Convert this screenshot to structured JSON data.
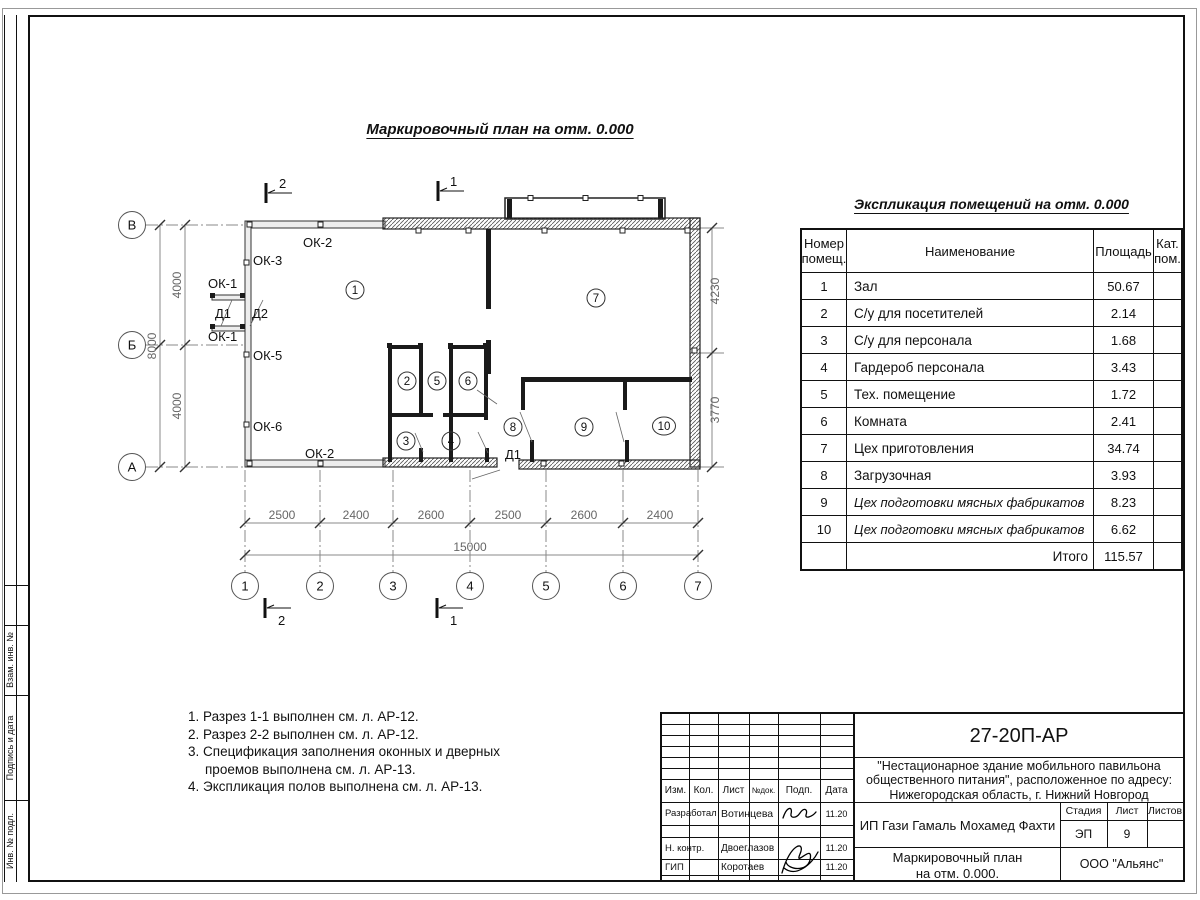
{
  "title": "Маркировочный план на отм. 0.000",
  "plan": {
    "marks": {
      "t2": "2",
      "t1": "1",
      "b2": "2",
      "b1": "1"
    },
    "rooms": [
      "1",
      "2",
      "3",
      "4",
      "5",
      "6",
      "7",
      "8",
      "9",
      "10"
    ],
    "row_axes": [
      "В",
      "Б",
      "А"
    ],
    "col_axes": [
      "1",
      "2",
      "3",
      "4",
      "5",
      "6",
      "7"
    ],
    "labels": {
      "ok2a": "ОК-2",
      "ok3": "ОК-3",
      "ok1a": "ОК-1",
      "d1": "Д1",
      "d2": "Д2",
      "ok1b": "ОК-1",
      "ok5": "ОК-5",
      "ok6": "ОК-6",
      "ok2b": "ОК-2",
      "d1b": "Д1"
    },
    "dims": {
      "v4000a": "4000",
      "v8000": "8000",
      "v4000b": "4000",
      "r4230": "4230",
      "r3770": "3770",
      "bottom": [
        "2500",
        "2400",
        "2600",
        "2500",
        "2600",
        "2400"
      ],
      "total": "15000"
    }
  },
  "expl": {
    "title": "Экспликация помещений на отм. 0.000",
    "headers": {
      "num": "Номер\nпомещ.",
      "name": "Наименование",
      "area": "Площадь",
      "cat": "Кат.\nпом."
    },
    "rows": [
      {
        "num": "1",
        "name": "Зал",
        "area": "50.67"
      },
      {
        "num": "2",
        "name": "С/у для посетителей",
        "area": "2.14"
      },
      {
        "num": "3",
        "name": "С/у для персонала",
        "area": "1.68"
      },
      {
        "num": "4",
        "name": "Гардероб персонала",
        "area": "3.43"
      },
      {
        "num": "5",
        "name": "Тех. помещение",
        "area": "1.72"
      },
      {
        "num": "6",
        "name": "Комната",
        "area": "2.41"
      },
      {
        "num": "7",
        "name": "Цех приготовления",
        "area": "34.74"
      },
      {
        "num": "8",
        "name": "Загрузочная",
        "area": "3.93"
      },
      {
        "num": "9",
        "name": "Цех подготовки мясных фабрикатов",
        "area": "8.23"
      },
      {
        "num": "10",
        "name": "Цех подготовки мясных фабрикатов",
        "area": "6.62"
      }
    ],
    "total_label": "Итого",
    "total_value": "115.57"
  },
  "notes": [
    "1. Разрез 1-1 выполнен см. л. АР-12.",
    "2. Разрез 2-2 выполнен см. л. АР-12.",
    "3. Спецификация заполнения оконных и дверных проемов выполнена см. л. АР-13.",
    "4. Экспликация полов выполнена см. л. АР-13."
  ],
  "side_labels": [
    "Взам. инв. №",
    "Подпись и дата",
    "Инв. № подл."
  ],
  "tb": {
    "doc": "27-20П-АР",
    "desc1": "\"Нестационарное здание мобильного павильона",
    "desc2": "общественного питания\", расположенное по адресу:",
    "desc3": "Нижегородская область, г. Нижний Новгород",
    "cols": [
      "Изм.",
      "Кол.",
      "Лист",
      "№док.",
      "Подп.",
      "Дата"
    ],
    "roles": {
      "r1": "Разработал",
      "r2": "Н. контр.",
      "r3": "ГИП"
    },
    "names": {
      "r1": "Вотинцева",
      "r2": "Двоеглазов",
      "r3": "Коротаев"
    },
    "dates": {
      "r1": "11.20",
      "r2": "11.20",
      "r3": "11.20"
    },
    "client": "ИП Гази Гамаль Мохамед Фахти",
    "stage_label": "Стадия",
    "sheet_label": "Лист",
    "sheets_label": "Листов",
    "stage": "ЭП",
    "sheet": "9",
    "sheets": "",
    "plan_name1": "Маркировочный план",
    "plan_name2": "на отм. 0.000.",
    "company": "ООО \"Альянс\""
  }
}
